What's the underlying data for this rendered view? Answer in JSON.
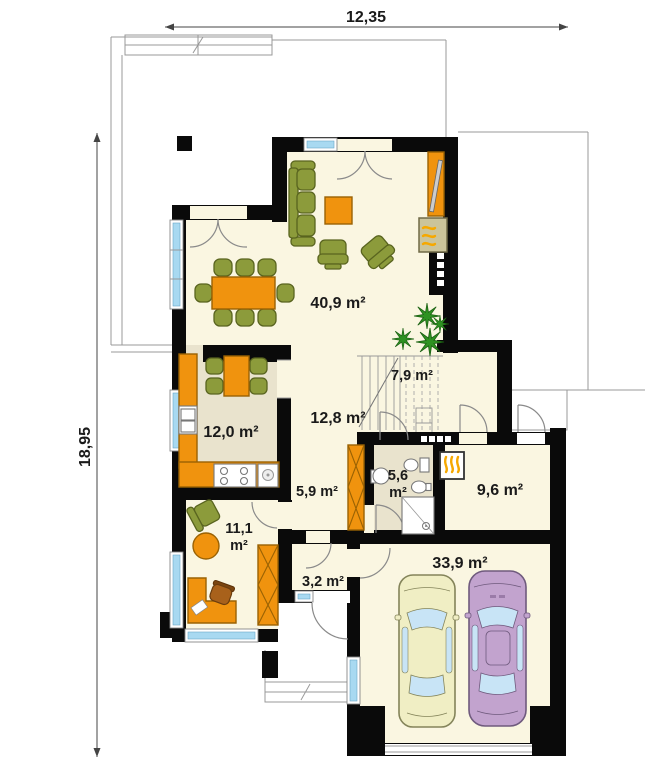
{
  "plan": {
    "title": "house-ground-floor-plan",
    "dimensions": {
      "top": "12,35",
      "left": "18,95"
    },
    "rooms": {
      "living": "40,9 m²",
      "stairs": "7,9 m²",
      "hall": "12,8 m²",
      "kitchen": "12,0 m²",
      "corridor": "5,9 m²",
      "bath_line1": "5,6",
      "bath_line2": "m²",
      "utility": "9,6 m²",
      "office_line1": "11,1",
      "office_line2": "m²",
      "vestibule": "3,2 m²",
      "garage": "33,9 m²"
    },
    "colors": {
      "wall": "#0a0a0a",
      "floor": "#FAF6E1",
      "floor_alt": "#E9E3CD",
      "furniture_orange": "#F0930E",
      "furniture_green": "#8C9B3B",
      "window_glass": "#A8D9F1",
      "car_yellow": "#F0EEC4",
      "car_purple": "#C2A3CE",
      "plant": "#2E9222",
      "flame": "#F6A800"
    }
  }
}
